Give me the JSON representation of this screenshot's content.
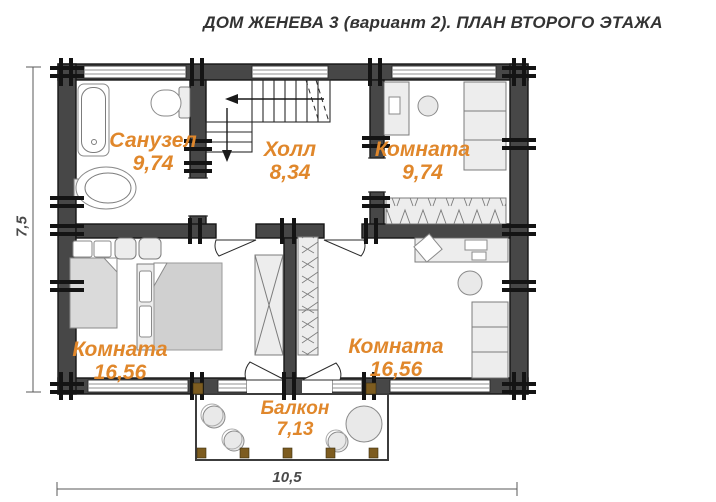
{
  "title": "ДОМ ЖЕНЕВА 3 (вариант 2). ПЛАН ВТОРОГО ЭТАЖА",
  "rooms": {
    "bathroom": {
      "name": "Санузел",
      "area": "9,74"
    },
    "hall": {
      "name": "Холл",
      "area": "8,34"
    },
    "room_top_right": {
      "name": "Комната",
      "area": "9,74"
    },
    "room_bottom_left": {
      "name": "Комната",
      "area": "16,56"
    },
    "room_bottom_right": {
      "name": "Комната",
      "area": "16,56"
    },
    "balcony": {
      "name": "Балкон",
      "area": "7,13"
    }
  },
  "dimensions": {
    "height": "7,5",
    "width": "10,5"
  },
  "colors": {
    "label_orange": "#e0872b",
    "wall_dark": "#474747",
    "wall_edge": "#161616",
    "tie_black": "#141414",
    "post_brown": "#7d5c20",
    "title_color": "#333333",
    "dim_color": "#4a4a4a"
  }
}
